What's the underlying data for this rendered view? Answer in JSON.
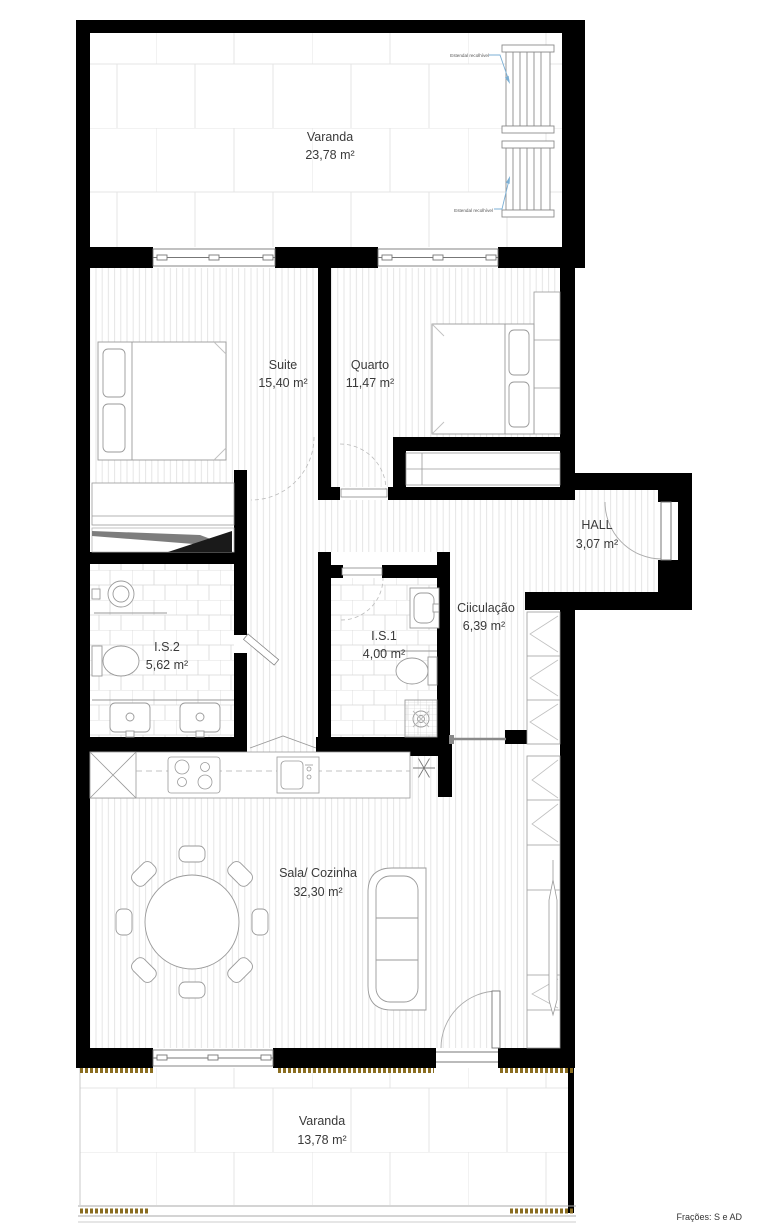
{
  "rooms": {
    "varanda_top": {
      "name": "Varanda",
      "area": "23,78 m²"
    },
    "suite": {
      "name": "Suite",
      "area": "15,40 m²"
    },
    "quarto": {
      "name": "Quarto",
      "area": "11,47 m²"
    },
    "hall": {
      "name": "HALL",
      "area": "3,07 m²"
    },
    "circulacao": {
      "name": "Ciiculação",
      "area": "6,39 m²"
    },
    "is2": {
      "name": "I.S.2",
      "area": "5,62 m²"
    },
    "is1": {
      "name": "I.S.1",
      "area": "4,00 m²"
    },
    "sala": {
      "name": "Sala/ Cozinha",
      "area": "32,30 m²"
    },
    "varanda_bottom": {
      "name": "Varanda",
      "area": "13,78 m²"
    }
  },
  "annotations": {
    "estendal_top": "Estendal recolhível",
    "estendal_bottom": "Estendal recolhível",
    "footer": "Frações: S e AD"
  },
  "colors": {
    "wall": "#000000",
    "leader_blue": "#7bafd4",
    "threshold_gold": "#8a6d20",
    "hatch_gray": "#e2e2e2"
  }
}
